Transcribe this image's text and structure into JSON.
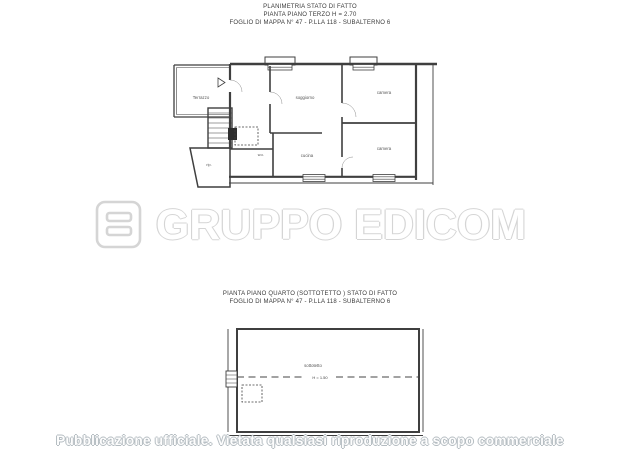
{
  "header_top": {
    "line1": "PLANIMETRIA STATO DI FATTO",
    "line2": "PIANTA PIANO TERZO  H = 2.70",
    "line3": "FOGLIO DI MAPPA N° 47 - P.LLA 118 - SUBALTERNO 6"
  },
  "plan_terzo": {
    "rooms": {
      "terrazzo": "Terrazzo",
      "soggiorno": "soggiorno",
      "camera_top": "camera",
      "camera_bottom": "camera",
      "cucina": "cucina",
      "wc": "w.c.",
      "rip": "rip."
    }
  },
  "watermark": {
    "brand": "GRUPPO EDICOM"
  },
  "header_bottom": {
    "line1": "PIANTA PIANO QUARTO (SOTTOTETTO ) STATO DI FATTO",
    "line2": "FOGLIO DI MAPPA N° 47 - P.LLA 118 - SUBALTERNO 6"
  },
  "plan_quarto": {
    "rooms": {
      "sottotetto": "sottotetto"
    },
    "height_label": "H = 1.50"
  },
  "footer": {
    "notice": "Pubblicazione ufficiale. Vietata qualsiasi riproduzione a scopo commerciale"
  },
  "colors": {
    "plan_line": "#3f3f3f",
    "watermark_outline": "#d5d5d5",
    "footer_outline": "#b4bcc1"
  }
}
